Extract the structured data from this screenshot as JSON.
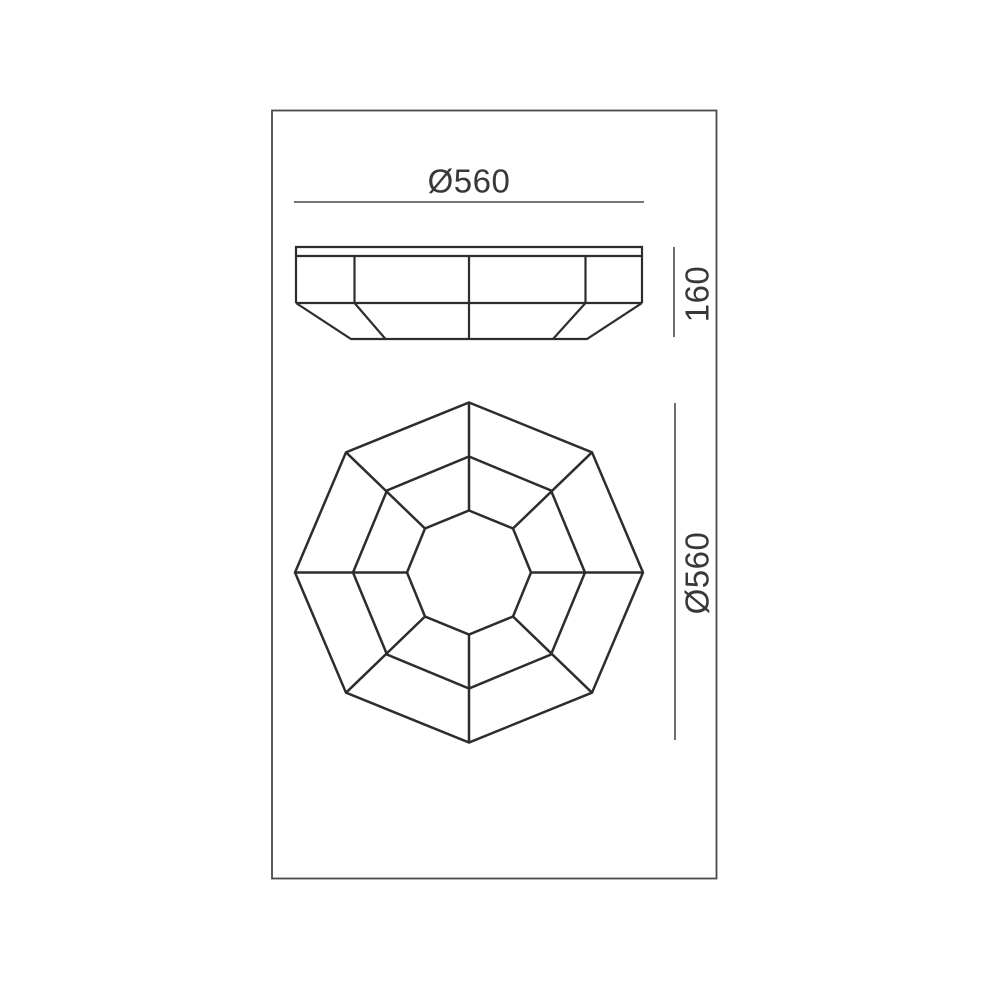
{
  "canvas": {
    "width": 990,
    "height": 990,
    "background": "#ffffff"
  },
  "frame": {
    "x": 272,
    "y": 110.5,
    "width": 444.5,
    "height": 768,
    "stroke": "#4a4a4a",
    "stroke_width": 1.8
  },
  "style": {
    "line_color": "#2d2d2d",
    "dim_line_color": "#4a4a4a",
    "dim_line_width": 1.6,
    "text_color": "#383838"
  },
  "side_view": {
    "name": "lamp-side-elevation",
    "stroke_width": 2.2,
    "paths": [
      {
        "name": "ceiling-plate",
        "d": "M296,247 H642 V256 H296 Z"
      },
      {
        "name": "rim-band",
        "d": "M296,256 V303 M642,256 V303 M296,303 H642"
      },
      {
        "name": "rim-band-facet-edges",
        "d": "M354.5,256 V303 M469,256 V303 M585.5,256 V303"
      },
      {
        "name": "bowl-silhouette",
        "d": "M296,303 L351,339 H587 L642,303"
      },
      {
        "name": "bowl-facet-edges",
        "d": "M354.5,303 L385.5,339 M469,303 V339 M585.5,303 L553,339"
      }
    ]
  },
  "plan_view": {
    "name": "lamp-plan-view",
    "stroke_width": 2.5,
    "polygons": [
      {
        "name": "outer-octagon",
        "points": "469,402.5 592,452.3 643,572.5 592,692.7 469,742.5 346,692.7 295,572.5 346,452.3"
      },
      {
        "name": "middle-octagon",
        "points": "469,456.5 551,490.5 585,572.5 551,654.5 469,688.5 387,654.5 353,572.5 387,490.5"
      },
      {
        "name": "inner-octagon",
        "points": "469,510.5 513,528.5 531,572.5 513,616.5 469,634.5 425,616.5 407,572.5 425,528.5"
      }
    ],
    "paths": [
      {
        "name": "facet-spokes",
        "d": "M469,402.5 V510.5 M592,452.3 L513,528.5 M643,572.5 H531 M592,692.7 L513,616.5 M469,742.5 V634.5 M346,692.7 L425,616.5 M295,572.5 H407 M346,452.3 L425,528.5"
      }
    ]
  },
  "dimensions": [
    {
      "name": "overall-diameter",
      "label": "Ø560",
      "orientation": "horizontal",
      "line": {
        "x1": 294,
        "y1": 202,
        "x2": 644,
        "y2": 202
      }
    },
    {
      "name": "overall-height",
      "label": "160",
      "orientation": "vertical",
      "line": {
        "x1": 674,
        "y1": 247,
        "x2": 674,
        "y2": 337
      }
    },
    {
      "name": "plan-diameter",
      "label": "Ø560",
      "orientation": "vertical",
      "line": {
        "x1": 675,
        "y1": 403,
        "x2": 675,
        "y2": 740
      }
    }
  ]
}
